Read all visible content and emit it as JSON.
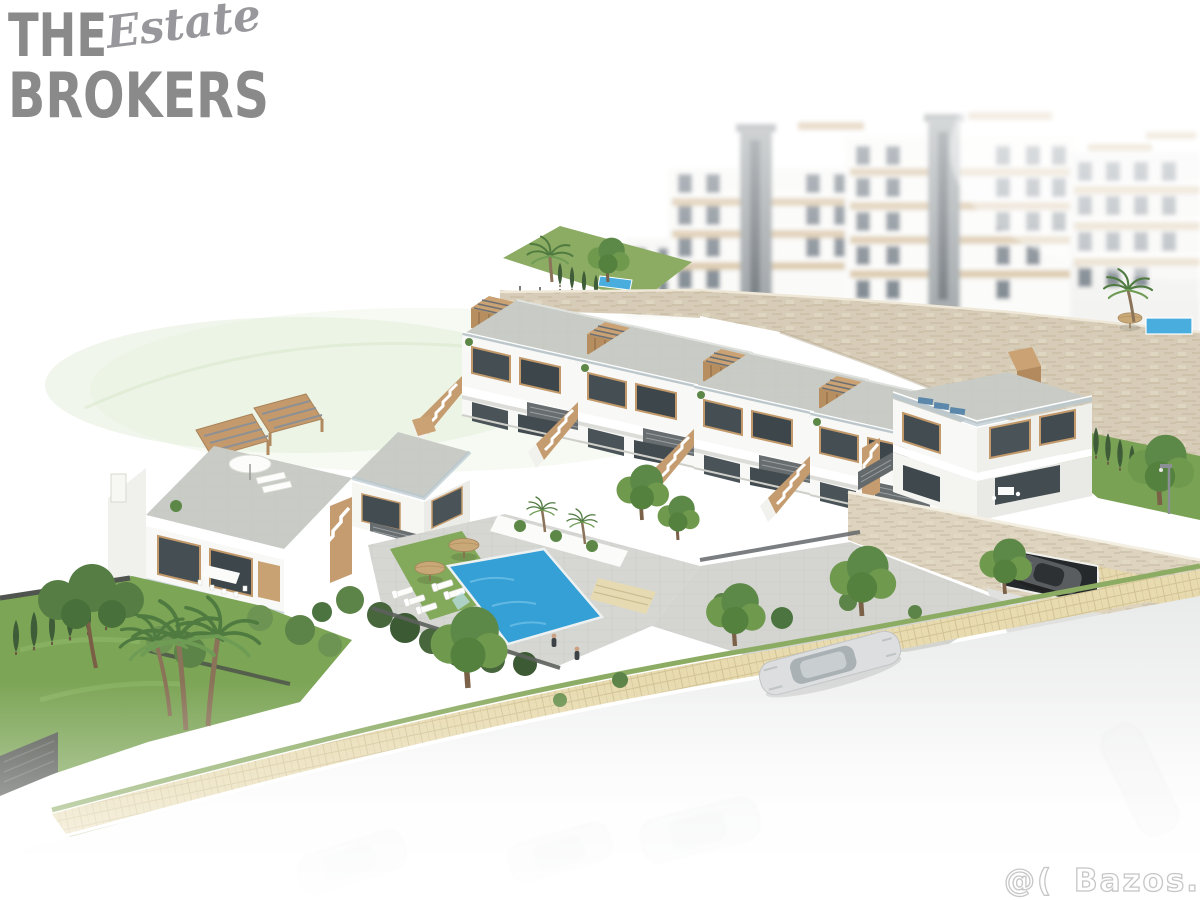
{
  "brand_logo": {
    "word_top": "THE",
    "word_script": "Estate",
    "word_bottom": "BROKERS",
    "color": "#8a8a8a"
  },
  "watermark": {
    "prefix": "@(",
    "site": "Bazos.cz",
    "color": "#c6c6c6"
  },
  "scene": {
    "description": "Aerial 3D render of a hillside new-build complex: white townhouses with wooden roof pergolas, a duplex villa, communal pool with umbrellas and loungers, stone retaining walls, background apartment blocks, landscaped gardens and a street fading to white",
    "colors": {
      "pool_water": "#35a0d6",
      "grass": "#7ca556",
      "hedge": "#47663c",
      "wood_accent": "#c49a6c",
      "stone_wall": "#d7ccb7",
      "roof_paving": "#c9ccc6",
      "facade_white": "#f8f8f6",
      "glazing": "#454e52",
      "road": "#e9eaea",
      "sidewalk": "#e8dbb0"
    }
  }
}
